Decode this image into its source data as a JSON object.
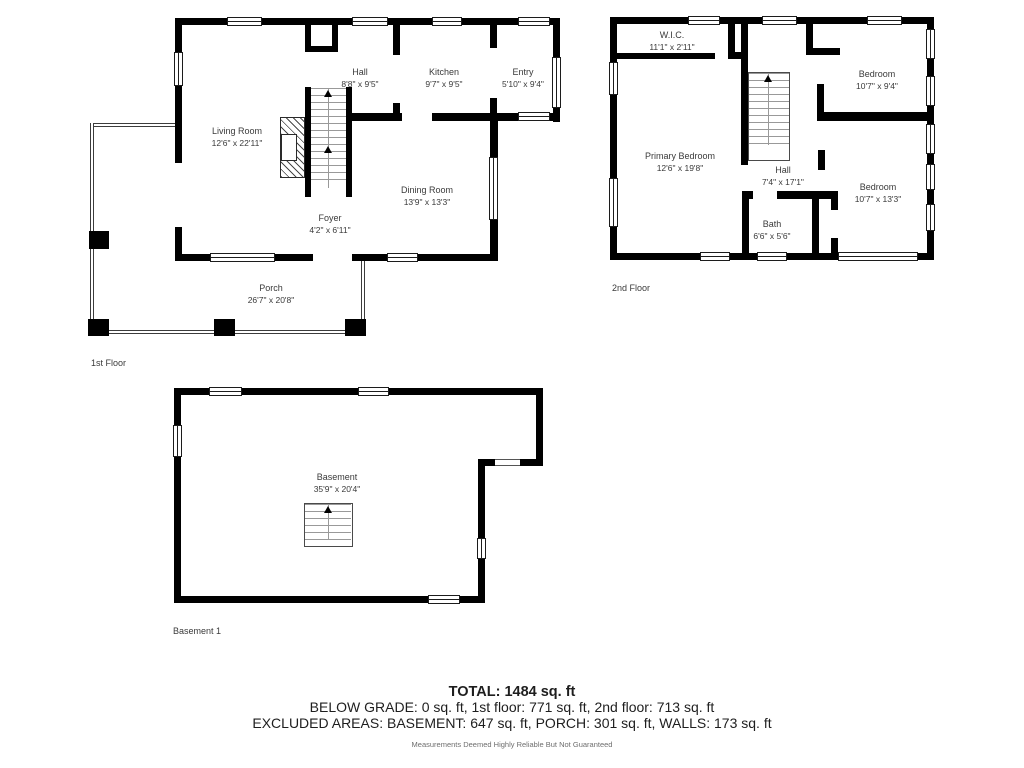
{
  "floors": {
    "first": {
      "label": "1st Floor",
      "rooms": {
        "living": {
          "name": "Living Room",
          "dims": "12'6\" x 22'11\""
        },
        "hall": {
          "name": "Hall",
          "dims": "8'8\" x 9'5\""
        },
        "kitchen": {
          "name": "Kitchen",
          "dims": "9'7\" x 9'5\""
        },
        "entry": {
          "name": "Entry",
          "dims": "5'10\" x 9'4\""
        },
        "dining": {
          "name": "Dining Room",
          "dims": "13'9\" x 13'3\""
        },
        "foyer": {
          "name": "Foyer",
          "dims": "4'2\" x 6'11\""
        },
        "porch": {
          "name": "Porch",
          "dims": "26'7\" x 20'8\""
        }
      }
    },
    "second": {
      "label": "2nd Floor",
      "rooms": {
        "wic": {
          "name": "W.I.C.",
          "dims": "11'1\" x 2'11\""
        },
        "primary": {
          "name": "Primary Bedroom",
          "dims": "12'6\" x 19'8\""
        },
        "bedroom_top": {
          "name": "Bedroom",
          "dims": "10'7\" x 9'4\""
        },
        "hall": {
          "name": "Hall",
          "dims": "7'4\" x 17'1\""
        },
        "bath": {
          "name": "Bath",
          "dims": "6'6\" x 5'6\""
        },
        "bedroom_bottom": {
          "name": "Bedroom",
          "dims": "10'7\" x 13'3\""
        }
      }
    },
    "basement": {
      "label": "Basement 1",
      "rooms": {
        "basement": {
          "name": "Basement",
          "dims": "35'9\" x 20'4\""
        }
      }
    }
  },
  "summary": {
    "total": "TOTAL: 1484 sq. ft",
    "below_grade": "BELOW GRADE: 0 sq. ft, 1st floor: 771 sq. ft, 2nd floor: 713 sq. ft",
    "excluded": "EXCLUDED AREAS: BASEMENT: 647 sq. ft, PORCH: 301 sq. ft, WALLS: 173 sq. ft",
    "disclaimer": "Measurements Deemed Highly Reliable But Not Guaranteed"
  },
  "colors": {
    "wall": "#000000",
    "label_text": "#3a3a3a",
    "summary_text": "#1e1e1e",
    "muted_text": "#6e6e6e"
  }
}
